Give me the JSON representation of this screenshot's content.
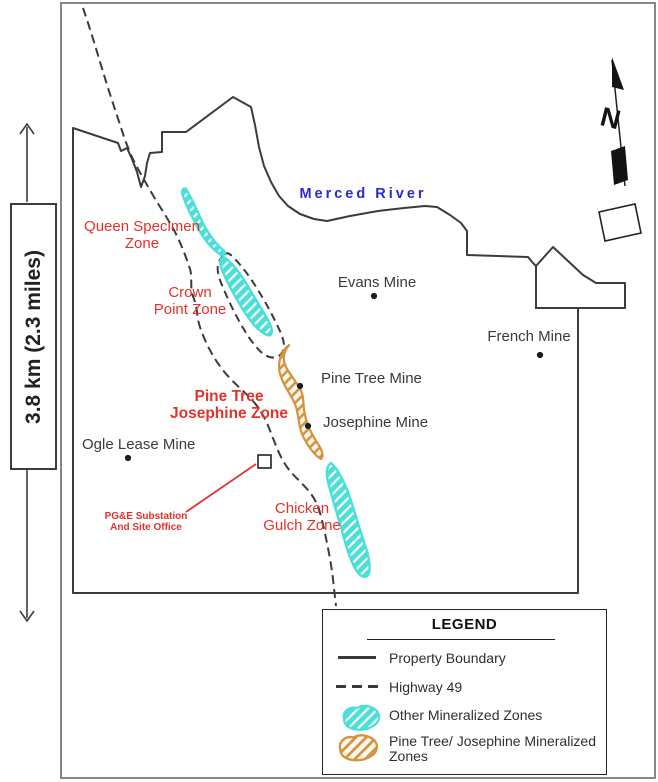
{
  "figure": {
    "scale_label": "3.8 km (2.3 miles)",
    "north_arrow_letter": "N"
  },
  "map": {
    "river_label": "Merced River",
    "zones": {
      "queen_specimen": {
        "line1": "Queen Specimen",
        "line2": "Zone"
      },
      "crown_point": {
        "line1": "Crown",
        "line2": "Point Zone"
      },
      "pine_tree_josephine": {
        "line1": "Pine Tree",
        "line2": "Josephine Zone"
      },
      "chicken_gulch": {
        "line1": "Chicken",
        "line2": "Gulch Zone"
      }
    },
    "mines": {
      "evans": "Evans Mine",
      "french": "French Mine",
      "pine_tree": "Pine Tree Mine",
      "josephine": "Josephine Mine",
      "ogle": "Ogle Lease Mine"
    },
    "substation": {
      "line1": "PG&E Substation",
      "line2": "And Site Office"
    }
  },
  "legend": {
    "title": "LEGEND",
    "items": [
      {
        "label": "Property Boundary",
        "swatch": "solid-line"
      },
      {
        "label": "Highway 49",
        "swatch": "dashed-line"
      },
      {
        "label": "Other Mineralized Zones",
        "swatch": "cyan-hatched-blob"
      },
      {
        "label": "Pine Tree/ Josephine Mineralized Zones",
        "swatch": "orange-hatched-blob"
      }
    ]
  },
  "colors": {
    "zone-red": "#e43129",
    "river-blue": "#2a2ac9",
    "other-zone-cyan": "#4adfd8",
    "ptj-zone-orange": "#d6913c",
    "line-dark": "#3b3b3b"
  }
}
